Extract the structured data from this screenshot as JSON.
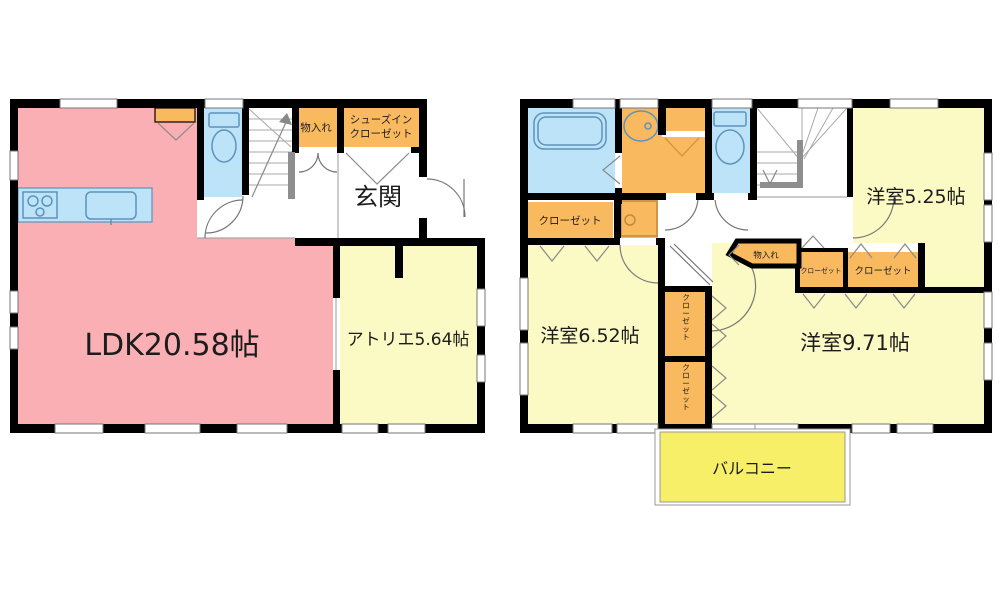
{
  "plan": {
    "floor1": {
      "ldk": "LDK20.58帖",
      "atelier": "アトリエ5.64帖",
      "genkan": "玄関",
      "monoire": "物入れ",
      "shoes_line1": "シューズイン",
      "shoes_line2": "クローゼット"
    },
    "floor2": {
      "room525": "洋室5.25帖",
      "room652": "洋室6.52帖",
      "room971": "洋室9.71帖",
      "balcony": "バルコニー",
      "closet_bath": "クローゼット",
      "closet_525": "クローゼット",
      "closet_small": "クローゼット",
      "closet_v1": "クローゼット",
      "closet_v2": "クローゼット",
      "monoire": "物入れ"
    },
    "colors": {
      "ldk_pink": "#F9AFB4",
      "room_yellow": "#FBF9C4",
      "closet_orange": "#F9B95E",
      "wet_area_blue": "#BCE3F7",
      "balcony_yellow": "#F6EF67",
      "wall_black": "#000000",
      "handrail_gray": "#8E8E8E"
    }
  }
}
